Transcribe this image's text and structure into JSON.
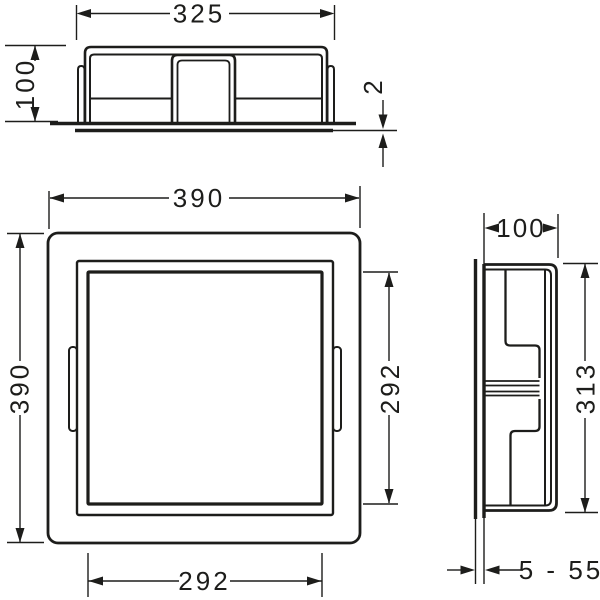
{
  "drawing": {
    "title": "wall-niche installation drawing",
    "views": {
      "top": {
        "label": "top-view",
        "dims": {
          "width": "325",
          "depth": "100",
          "flange_thickness": "2"
        }
      },
      "front": {
        "label": "front-view",
        "dims": {
          "outer_width": "390",
          "outer_height": "390",
          "opening_width": "292",
          "opening_height": "292"
        }
      },
      "side": {
        "label": "side-view",
        "dims": {
          "depth": "100",
          "inner_height": "313",
          "tile_thickness_range": "5 - 55"
        }
      }
    },
    "colors": {
      "line": "#1d1d1b",
      "background": "#ffffff"
    }
  }
}
